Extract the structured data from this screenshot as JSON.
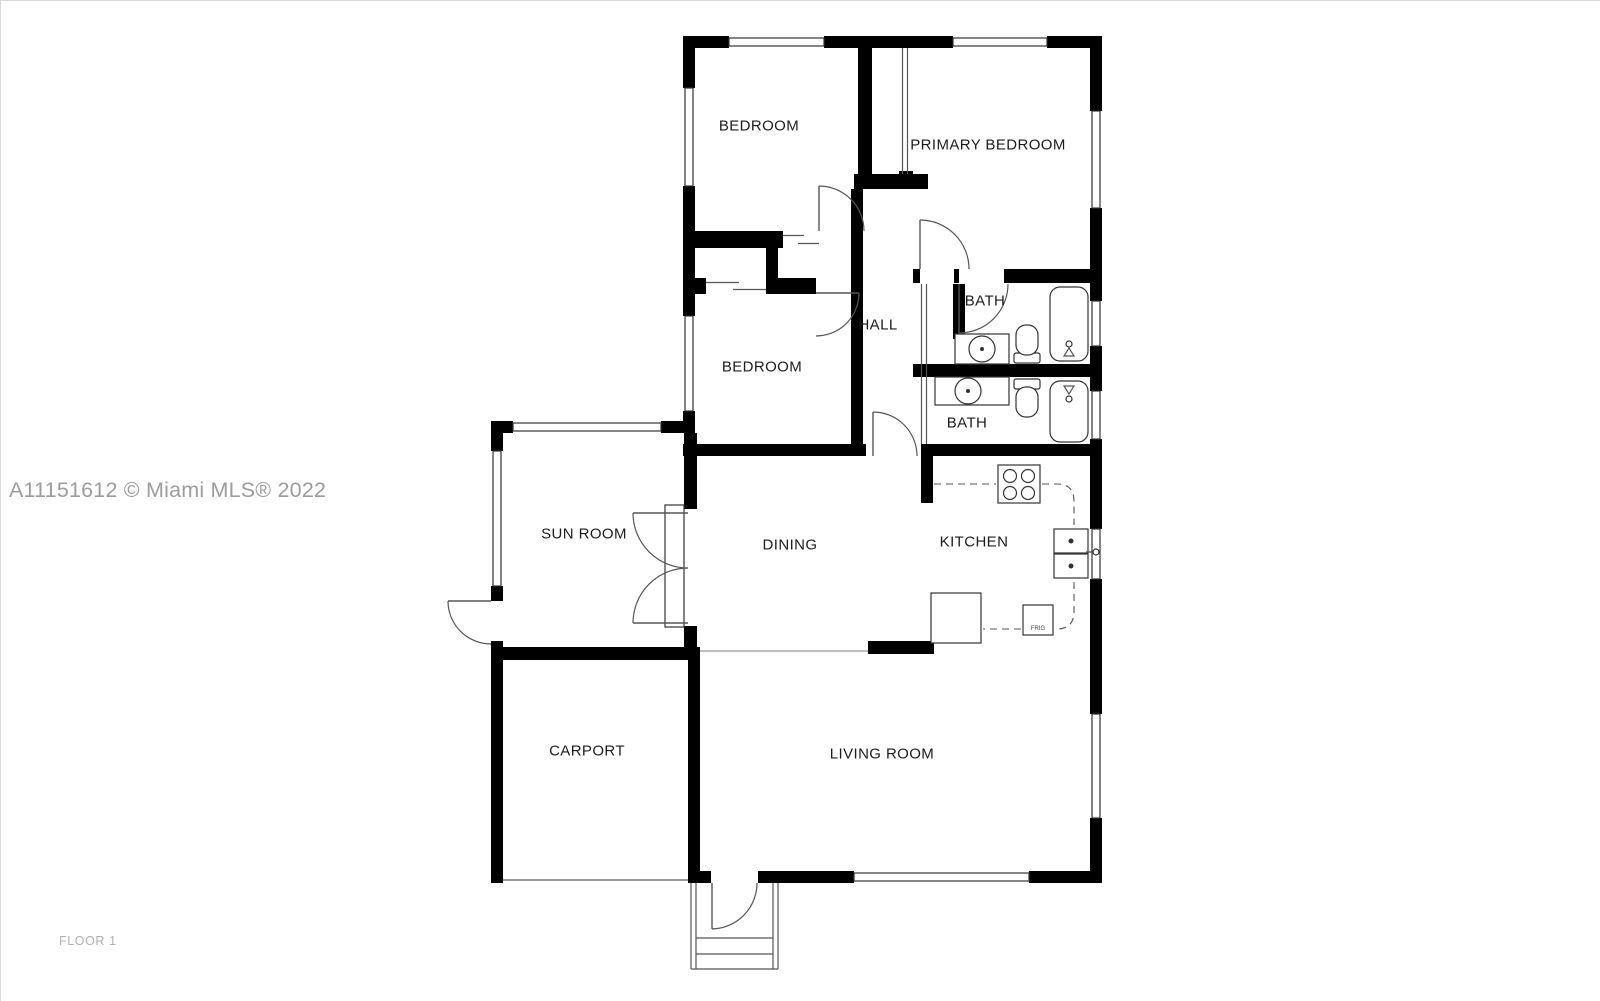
{
  "page": {
    "background": "#ffffff",
    "border_color": "#d9d9d9",
    "wall_color": "#000000",
    "label_color": "#1c1c1c"
  },
  "watermark": {
    "text": "A11151612 © Miami MLS® 2022",
    "color": "#9c9c9c"
  },
  "floor": {
    "label": "FLOOR 1",
    "color": "#b0b0b0"
  },
  "plan": {
    "rooms": [
      {
        "id": "bedroom-top",
        "label": "BEDROOM"
      },
      {
        "id": "primary-bedroom",
        "label": "PRIMARY BEDROOM"
      },
      {
        "id": "hall",
        "label": "HALL"
      },
      {
        "id": "bath-upper",
        "label": "BATH"
      },
      {
        "id": "bedroom-middle",
        "label": "BEDROOM"
      },
      {
        "id": "bath-lower",
        "label": "BATH"
      },
      {
        "id": "sun-room",
        "label": "SUN ROOM"
      },
      {
        "id": "dining",
        "label": "DINING"
      },
      {
        "id": "kitchen",
        "label": "KITCHEN"
      },
      {
        "id": "carport",
        "label": "CARPORT"
      },
      {
        "id": "living-room",
        "label": "LIVING ROOM"
      }
    ],
    "appliances": {
      "refrigerator_label": "FRIG"
    },
    "fixtures": {
      "bath_upper": [
        "bathtub",
        "toilet",
        "sink-vanity"
      ],
      "bath_lower": [
        "bathtub",
        "toilet",
        "sink-vanity"
      ],
      "kitchen": [
        "stove-4-burner",
        "double-sink",
        "counter",
        "refrigerator"
      ],
      "entry": [
        "front-door",
        "porch-steps"
      ]
    }
  }
}
